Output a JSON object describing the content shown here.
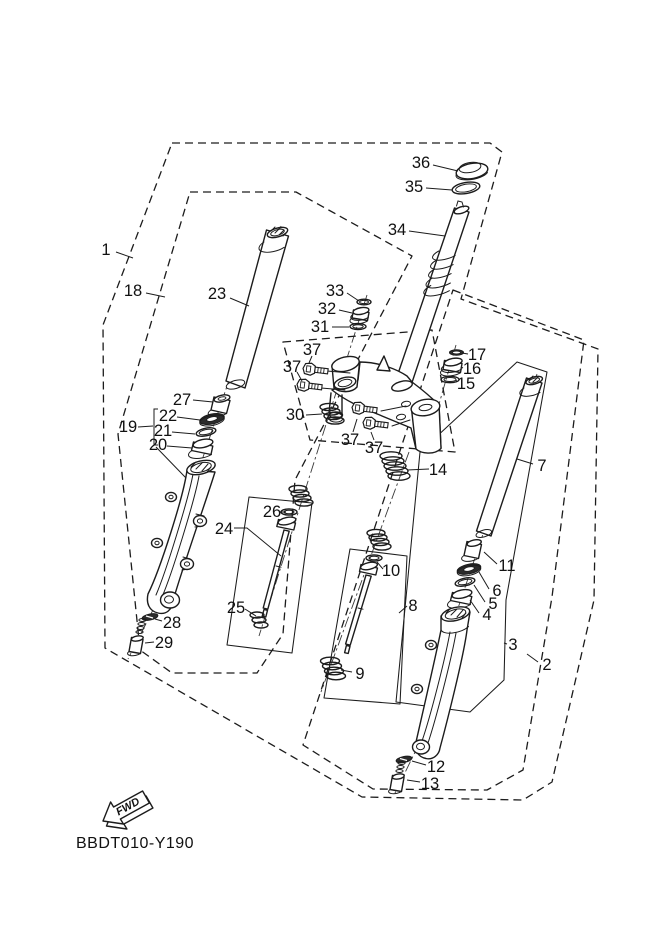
{
  "diagram": {
    "code": "BBDT010-Y190",
    "fwd_label": "FWD",
    "colors": {
      "line": "#1c1c1c",
      "background": "#ffffff",
      "seal_fill": "#2b2b2b"
    },
    "part_labels": [
      {
        "n": "1",
        "x": 106,
        "y": 250,
        "leader": [
          [
            116,
            252
          ],
          [
            133,
            258
          ]
        ]
      },
      {
        "n": "18",
        "x": 133,
        "y": 291,
        "leader": [
          [
            146,
            293
          ],
          [
            165,
            297
          ]
        ]
      },
      {
        "n": "23",
        "x": 217,
        "y": 294,
        "leader": [
          [
            230,
            298
          ],
          [
            249,
            306
          ]
        ]
      },
      {
        "n": "36",
        "x": 421,
        "y": 163,
        "leader": [
          [
            433,
            165
          ],
          [
            458,
            171
          ]
        ]
      },
      {
        "n": "35",
        "x": 414,
        "y": 187,
        "leader": [
          [
            426,
            188
          ],
          [
            452,
            190
          ]
        ]
      },
      {
        "n": "34",
        "x": 397,
        "y": 230,
        "leader": [
          [
            409,
            231
          ],
          [
            445,
            236
          ]
        ]
      },
      {
        "n": "33",
        "x": 335,
        "y": 291,
        "leader": [
          [
            347,
            293
          ],
          [
            359,
            301
          ]
        ]
      },
      {
        "n": "32",
        "x": 327,
        "y": 309,
        "leader": [
          [
            339,
            310
          ],
          [
            352,
            313
          ]
        ]
      },
      {
        "n": "31",
        "x": 320,
        "y": 327,
        "leader": [
          [
            332,
            327
          ],
          [
            349,
            327
          ]
        ]
      },
      {
        "n": "37",
        "x": 312,
        "y": 350,
        "leader": [
          [
            312,
            356
          ],
          [
            309,
            363
          ]
        ]
      },
      {
        "n": "37",
        "x": 292,
        "y": 367,
        "leader": [
          [
            297,
            372
          ],
          [
            302,
            381
          ]
        ]
      },
      {
        "n": "30",
        "x": 295,
        "y": 415,
        "leader": [
          [
            306,
            415
          ],
          [
            322,
            414
          ]
        ]
      },
      {
        "n": "37",
        "x": 350,
        "y": 440,
        "leader": [
          [
            353,
            432
          ],
          [
            357,
            419
          ]
        ]
      },
      {
        "n": "37",
        "x": 374,
        "y": 448,
        "leader": [
          [
            374,
            440
          ],
          [
            371,
            432
          ]
        ]
      },
      {
        "n": "17",
        "x": 477,
        "y": 355,
        "leader": [
          [
            468,
            354
          ],
          [
            462,
            353
          ]
        ]
      },
      {
        "n": "16",
        "x": 472,
        "y": 369,
        "leader": [
          [
            463,
            368
          ],
          [
            461,
            367
          ]
        ]
      },
      {
        "n": "15",
        "x": 466,
        "y": 384,
        "leader": [
          [
            457,
            382
          ],
          [
            456,
            380
          ]
        ]
      },
      {
        "n": "14",
        "x": 438,
        "y": 470,
        "leader": [
          [
            429,
            469
          ],
          [
            407,
            470
          ]
        ]
      },
      {
        "n": "27",
        "x": 182,
        "y": 400,
        "leader": [
          [
            193,
            400
          ],
          [
            213,
            402
          ]
        ]
      },
      {
        "n": "19",
        "x": 128,
        "y": 427,
        "leader": [
          [
            138,
            427
          ],
          [
            153,
            426
          ]
        ]
      },
      {
        "n": "22",
        "x": 168,
        "y": 416,
        "leader": [
          [
            177,
            417
          ],
          [
            200,
            420
          ]
        ]
      },
      {
        "n": "21",
        "x": 163,
        "y": 431,
        "leader": [
          [
            172,
            432
          ],
          [
            195,
            434
          ]
        ]
      },
      {
        "n": "20",
        "x": 158,
        "y": 445,
        "leader": [
          [
            167,
            446
          ],
          [
            192,
            448
          ]
        ]
      },
      {
        "n": "24",
        "x": 224,
        "y": 529,
        "leader": [
          [
            234,
            528
          ],
          [
            247,
            528
          ],
          [
            281,
            556
          ]
        ]
      },
      {
        "n": "26",
        "x": 272,
        "y": 512,
        "leader": [
          [
            280,
            512
          ],
          [
            286,
            512
          ]
        ]
      },
      {
        "n": "25",
        "x": 236,
        "y": 608,
        "leader": [
          [
            245,
            609
          ],
          [
            256,
            616
          ]
        ]
      },
      {
        "n": "28",
        "x": 172,
        "y": 623,
        "leader": [
          [
            162,
            621
          ],
          [
            155,
            619
          ]
        ]
      },
      {
        "n": "29",
        "x": 164,
        "y": 643,
        "leader": [
          [
            154,
            642
          ],
          [
            145,
            643
          ]
        ]
      },
      {
        "n": "9",
        "x": 360,
        "y": 674,
        "leader": [
          [
            352,
            672
          ],
          [
            341,
            670
          ]
        ]
      },
      {
        "n": "10",
        "x": 391,
        "y": 571,
        "leader": [
          [
            383,
            569
          ],
          [
            377,
            562
          ]
        ]
      },
      {
        "n": "8",
        "x": 413,
        "y": 606,
        "leader": [
          [
            407,
            606
          ],
          [
            399,
            613
          ]
        ]
      },
      {
        "n": "11",
        "x": 507,
        "y": 566,
        "leader": [
          [
            497,
            564
          ],
          [
            484,
            552
          ]
        ]
      },
      {
        "n": "6",
        "x": 497,
        "y": 591,
        "leader": [
          [
            489,
            589
          ],
          [
            479,
            572
          ]
        ]
      },
      {
        "n": "5",
        "x": 493,
        "y": 604,
        "leader": [
          [
            485,
            602
          ],
          [
            474,
            585
          ]
        ]
      },
      {
        "n": "4",
        "x": 487,
        "y": 615,
        "leader": [
          [
            479,
            613
          ],
          [
            470,
            600
          ]
        ]
      },
      {
        "n": "3",
        "x": 513,
        "y": 645,
        "leader": [
          [
            507,
            644
          ],
          [
            504,
            643
          ]
        ]
      },
      {
        "n": "2",
        "x": 547,
        "y": 665,
        "leader": [
          [
            538,
            662
          ],
          [
            527,
            654
          ]
        ]
      },
      {
        "n": "7",
        "x": 542,
        "y": 466,
        "leader": [
          [
            533,
            464
          ],
          [
            517,
            459
          ]
        ]
      },
      {
        "n": "12",
        "x": 436,
        "y": 767,
        "leader": [
          [
            426,
            765
          ],
          [
            412,
            761
          ]
        ]
      },
      {
        "n": "13",
        "x": 430,
        "y": 784,
        "leader": [
          [
            420,
            782
          ],
          [
            407,
            780
          ]
        ]
      }
    ]
  }
}
